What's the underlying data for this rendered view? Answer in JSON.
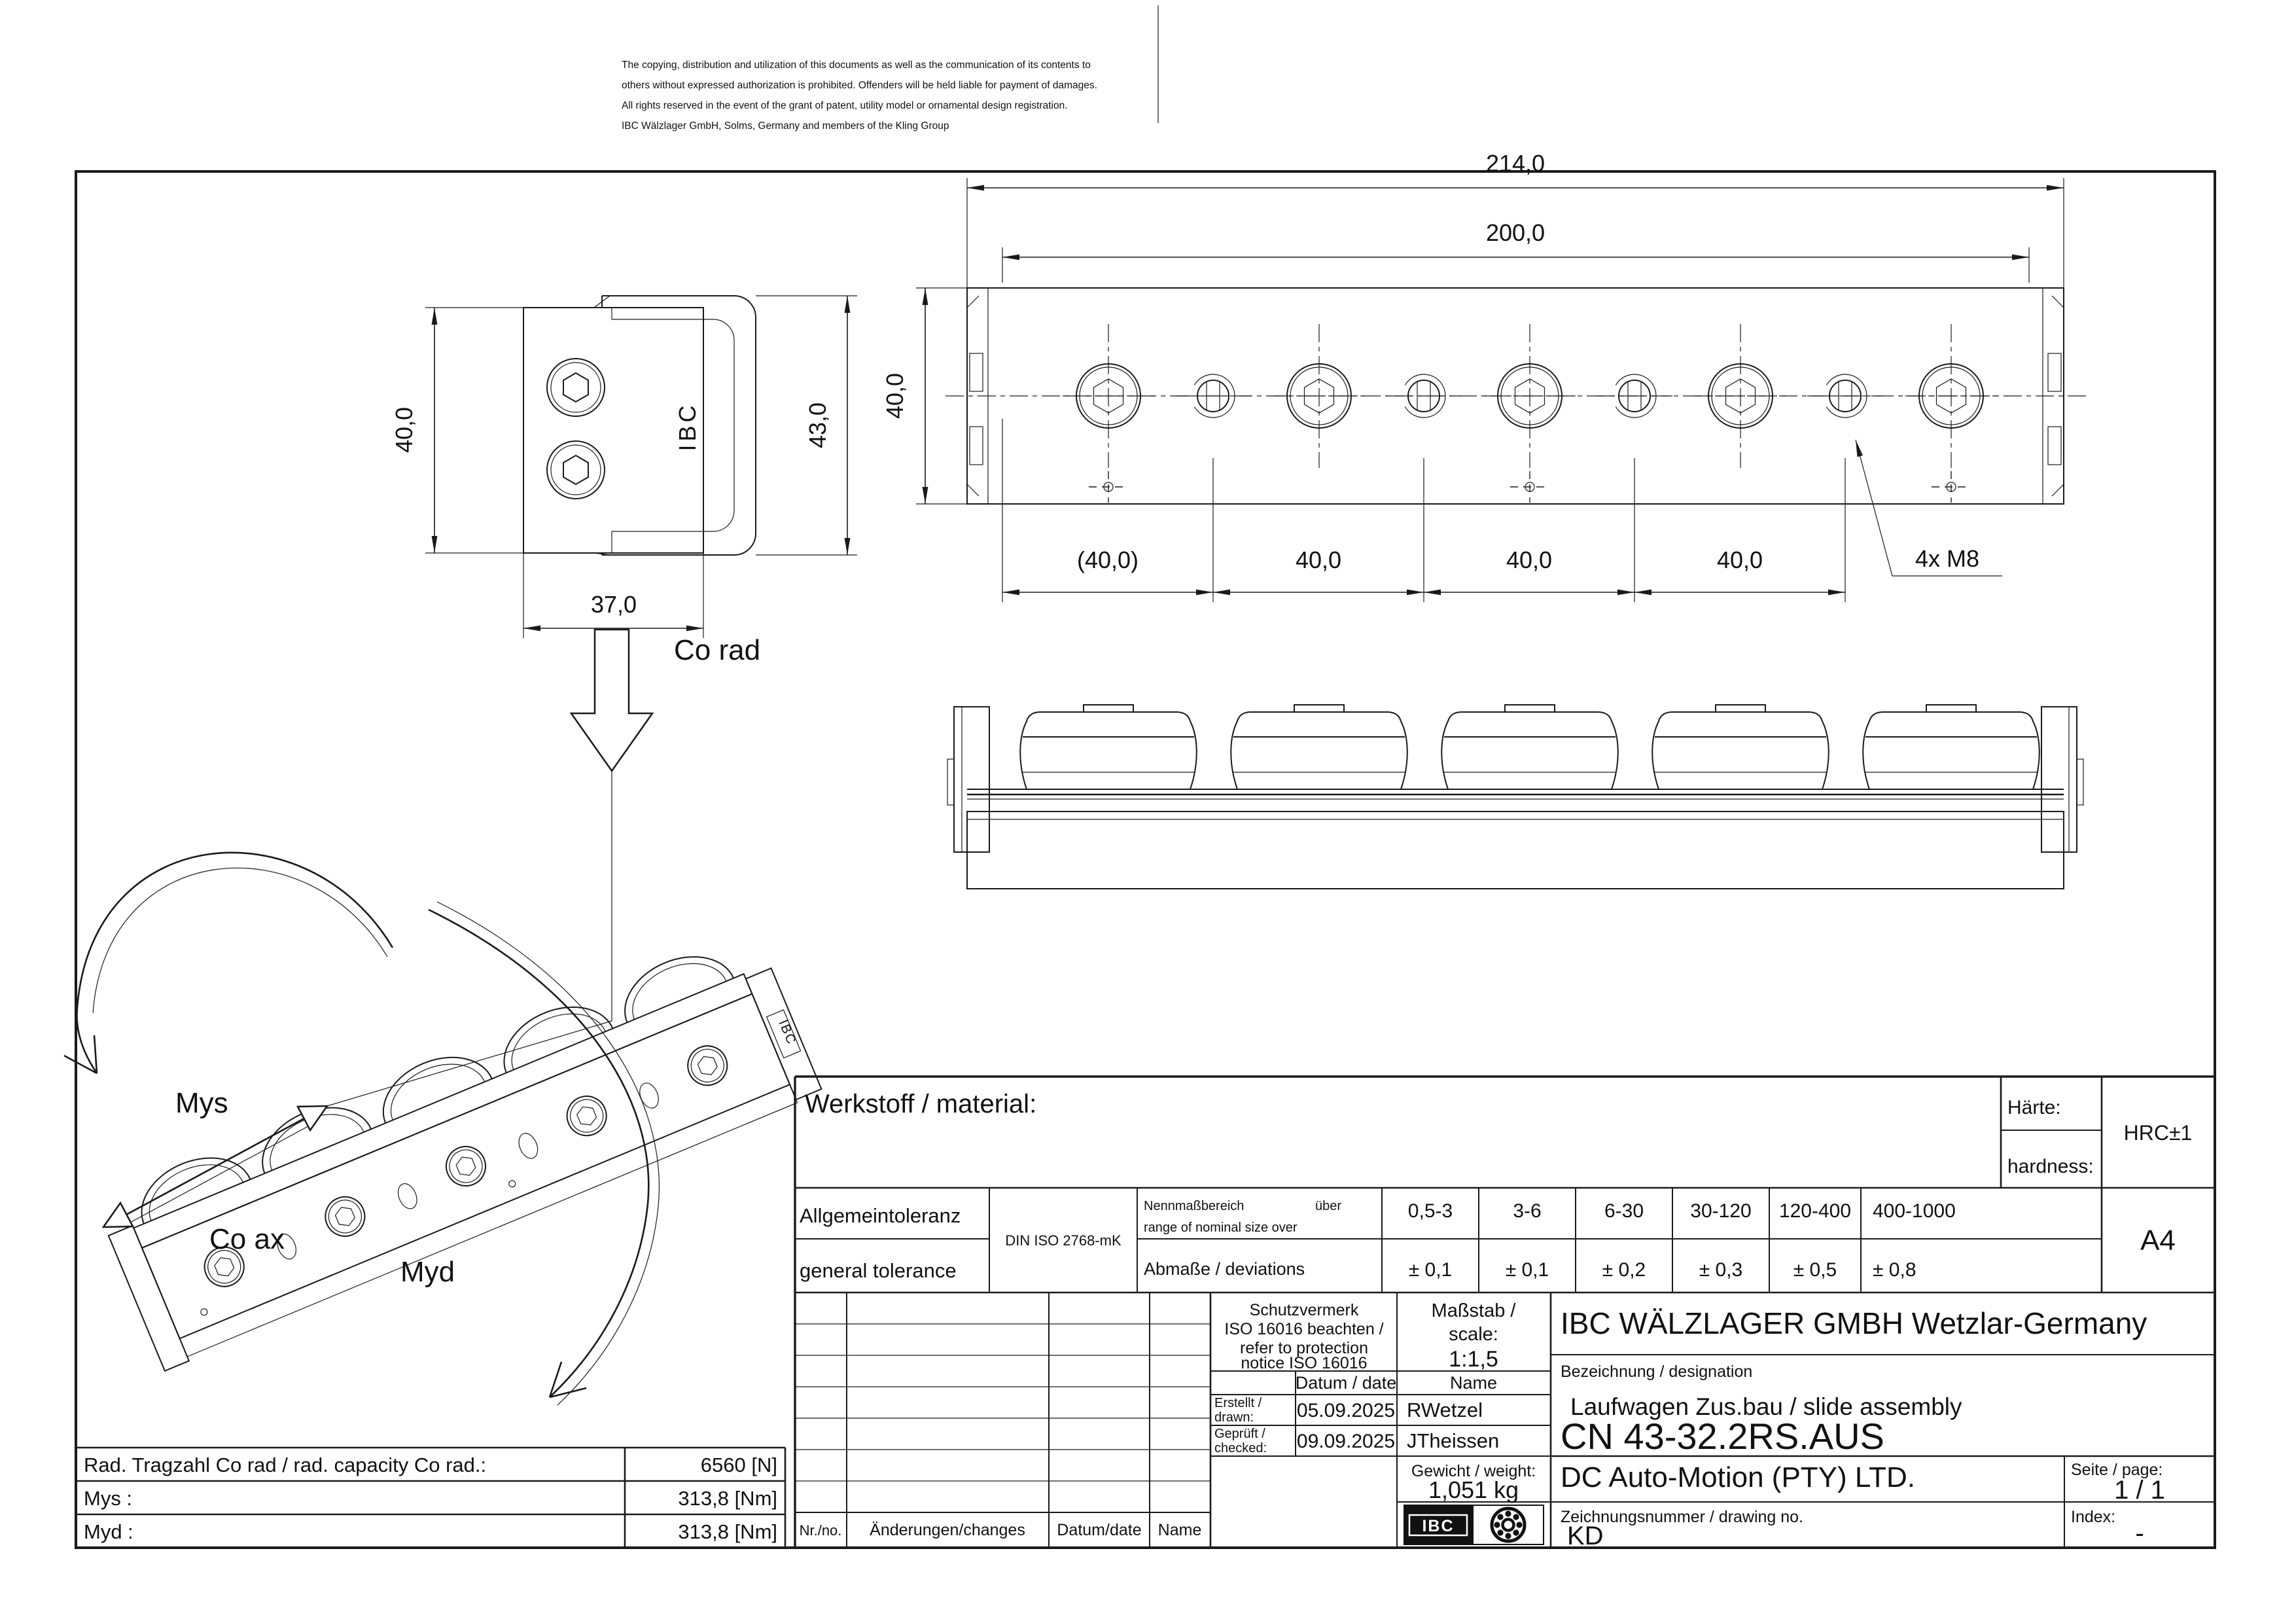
{
  "disclaimer": {
    "line1": "The copying, distribution and utilization of this documents as well as the communication of its contents to",
    "line2": "others without expressed authorization is prohibited. Offenders will be held liable for payment of damages.",
    "line3": "All rights reserved in the event of the grant of patent, utility model or ornamental design registration.",
    "line4": "IBC Wälzlager GmbH, Solms, Germany and members of the Kling Group"
  },
  "end_view": {
    "dim_height": "40,0",
    "dim_total_height": "43,0",
    "dim_width": "37,0",
    "logo": "IBC"
  },
  "plan_view": {
    "dim_overall": "214,0",
    "dim_span": "200,0",
    "dim_height": "40,0",
    "pitches": [
      "(40,0)",
      "40,0",
      "40,0",
      "40,0"
    ],
    "thread_note": "4x M8"
  },
  "iso_view": {
    "co_rad": "Co rad",
    "mys": "Mys",
    "co_ax": "Co ax",
    "myd": "Myd",
    "logo": "IBC"
  },
  "capacity_table": {
    "rows": [
      {
        "label": "Rad. Tragzahl Co rad / rad. capacity Co rad.:",
        "value": "6560 [N]"
      },
      {
        "label": "Mys :",
        "value": "313,8 [Nm]"
      },
      {
        "label": "Myd :",
        "value": "313,8 [Nm]"
      }
    ]
  },
  "title_block": {
    "material_label": "Werkstoff / material:",
    "hardness_label_de": "Härte:",
    "hardness_label_en": "hardness:",
    "hardness_value": "HRC±1",
    "format": "A4",
    "tolerance": {
      "label_de": "Allgemeintoleranz",
      "label_en": "general tolerance",
      "standard": "DIN ISO 2768-mK",
      "range_label_de": "Nennmaßbereich",
      "range_label_over": "über",
      "range_label_en": "range of nominal size over",
      "deviation_label": "Abmaße / deviations",
      "columns": [
        {
          "range": "0,5-3",
          "dev": "± 0,1"
        },
        {
          "range": "3-6",
          "dev": "± 0,1"
        },
        {
          "range": "6-30",
          "dev": "± 0,2"
        },
        {
          "range": "30-120",
          "dev": "± 0,3"
        },
        {
          "range": "120-400",
          "dev": "± 0,5"
        },
        {
          "range": "400-1000",
          "dev": "± 0,8"
        }
      ]
    },
    "protection": {
      "line1": "Schutzvermerk",
      "line2": "ISO 16016 beachten /",
      "line3": "refer to protection",
      "line4": "notice ISO 16016"
    },
    "scale_label_de": "Maßstab /",
    "scale_label_en": "scale:",
    "scale_value": "1:1,5",
    "company": "IBC WÄLZLAGER GMBH Wetzlar-Germany",
    "designation_label": "Bezeichnung / designation",
    "designation": "Laufwagen Zus.bau / slide assembly",
    "part_number": "CN 43-32.2RS.AUS",
    "date_header": "Datum / date",
    "name_header": "Name",
    "drawn_label_de": "Erstellt /",
    "drawn_label_en": "drawn:",
    "drawn_date": "05.09.2025",
    "drawn_name": "RWetzel",
    "checked_label_de": "Geprüft /",
    "checked_label_en": "checked:",
    "checked_date": "09.09.2025",
    "checked_name": "JTheissen",
    "weight_label": "Gewicht / weight:",
    "weight_value": "1,051 kg",
    "customer": "DC Auto-Motion (PTY) LTD.",
    "page_label": "Seite / page:",
    "page_value": "1 / 1",
    "drawing_no_label": "Zeichnungsnummer / drawing no.",
    "drawing_no": "KD",
    "index_label": "Index:",
    "index_value": "-",
    "logo_text": "IBC",
    "revision": {
      "nr": "Nr./no.",
      "changes": "Änderungen/changes",
      "date": "Datum/date",
      "name": "Name"
    }
  }
}
